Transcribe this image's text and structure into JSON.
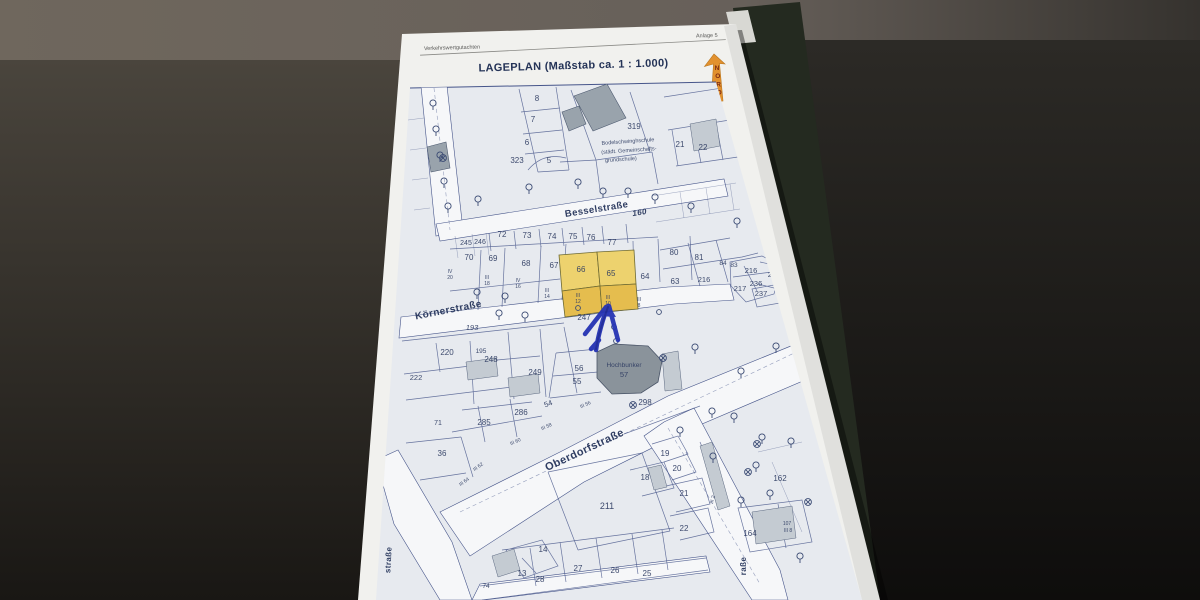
{
  "page": {
    "header_left": "Verkehrswertgutachten",
    "header_right": "Anlage 5",
    "title": "LAGEPLAN (Maßstab ca. 1 : 1.000)",
    "north_label": "NORD"
  },
  "colors": {
    "table-brown": "#6f675d",
    "bg-dark": "#171614",
    "paper": "#f1f1ee",
    "map-bg": "#e7eaef",
    "street": "#f6f7f9",
    "ink": "#46558a",
    "ink-text": "#2e3c62",
    "ink-street": "#26355b",
    "building": "#c4cbd2",
    "building-dark": "#99a3ac",
    "bunker": "#8a939b",
    "highlight-light": "#edd26e",
    "highlight-dark": "#e5bd4e",
    "arrow-blue": "#2533b4",
    "north-orange": "#e2912e",
    "north-text": "#7c2a12"
  },
  "map": {
    "bunker_name": "Hochbunker",
    "school_name": "Bodelschwinghschule (städt. Gemeinschafts- grundschule)",
    "highlighted_parcels": [
      "66",
      "65"
    ],
    "street_labels": [
      {
        "t": "Besselstraße",
        "x": 597,
        "y": 212,
        "r": -9,
        "fs": 9.5
      },
      {
        "t": "160",
        "x": 640,
        "y": 215,
        "r": -9,
        "fs": 8,
        "i": 1
      },
      {
        "t": "Körnerstraße",
        "x": 449,
        "y": 313,
        "r": -11,
        "fs": 10
      },
      {
        "t": "Oberdorfstraße",
        "x": 586,
        "y": 453,
        "r": -25,
        "fs": 11
      },
      {
        "t": "raße",
        "x": 746,
        "y": 566,
        "r": -90,
        "fs": 8
      },
      {
        "t": "straße",
        "x": 391,
        "y": 560,
        "r": -87,
        "fs": 8
      }
    ],
    "labels": [
      {
        "t": "8",
        "x": 537,
        "y": 101
      },
      {
        "t": "7",
        "x": 533,
        "y": 122
      },
      {
        "t": "6",
        "x": 527,
        "y": 145
      },
      {
        "t": "5",
        "x": 549,
        "y": 163
      },
      {
        "t": "323",
        "x": 517,
        "y": 163
      },
      {
        "t": "319",
        "x": 634,
        "y": 129
      },
      {
        "t": "21",
        "x": 680,
        "y": 147
      },
      {
        "t": "22",
        "x": 703,
        "y": 150
      },
      {
        "t": "Bodelschwinghschule",
        "x": 628,
        "y": 143,
        "fs": 5.5,
        "r": -4
      },
      {
        "t": "(städt. Gemeinschafts-",
        "x": 629,
        "y": 152,
        "fs": 5.5,
        "r": -4
      },
      {
        "t": "grundschule)",
        "x": 621,
        "y": 161,
        "fs": 5.5,
        "r": -4
      },
      {
        "t": "245",
        "x": 466,
        "y": 245,
        "fs": 7
      },
      {
        "t": "246",
        "x": 480,
        "y": 244,
        "fs": 7
      },
      {
        "t": "72",
        "x": 502,
        "y": 237
      },
      {
        "t": "73",
        "x": 527,
        "y": 238
      },
      {
        "t": "74",
        "x": 552,
        "y": 239
      },
      {
        "t": "75",
        "x": 573,
        "y": 239
      },
      {
        "t": "76",
        "x": 591,
        "y": 240
      },
      {
        "t": "77",
        "x": 612,
        "y": 245
      },
      {
        "t": "70",
        "x": 469,
        "y": 260
      },
      {
        "t": "69",
        "x": 493,
        "y": 261
      },
      {
        "t": "68",
        "x": 526,
        "y": 266
      },
      {
        "t": "67",
        "x": 554,
        "y": 268
      },
      {
        "t": "66",
        "x": 581,
        "y": 272
      },
      {
        "t": "65",
        "x": 611,
        "y": 276
      },
      {
        "t": "64",
        "x": 645,
        "y": 279
      },
      {
        "t": "63",
        "x": 675,
        "y": 284
      },
      {
        "t": "80",
        "x": 674,
        "y": 255
      },
      {
        "t": "81",
        "x": 699,
        "y": 260
      },
      {
        "t": "84",
        "x": 723,
        "y": 265,
        "fs": 6.5
      },
      {
        "t": "83",
        "x": 734,
        "y": 267,
        "fs": 6.5
      },
      {
        "t": "216",
        "x": 704,
        "y": 282,
        "fs": 7.5
      },
      {
        "t": "216",
        "x": 751,
        "y": 273,
        "fs": 7.5
      },
      {
        "t": "228",
        "x": 774,
        "y": 277,
        "fs": 7.5
      },
      {
        "t": "236",
        "x": 756,
        "y": 286,
        "fs": 7.5
      },
      {
        "t": "217",
        "x": 740,
        "y": 291,
        "fs": 7.5
      },
      {
        "t": "237",
        "x": 761,
        "y": 296,
        "fs": 7.5
      },
      {
        "t": "IV",
        "x": 450,
        "y": 273,
        "fs": 5
      },
      {
        "t": "20",
        "x": 450,
        "y": 279,
        "fs": 5
      },
      {
        "t": "III",
        "x": 487,
        "y": 279,
        "fs": 5
      },
      {
        "t": "18",
        "x": 487,
        "y": 285,
        "fs": 5
      },
      {
        "t": "IV",
        "x": 518,
        "y": 282,
        "fs": 5
      },
      {
        "t": "16",
        "x": 518,
        "y": 288,
        "fs": 5
      },
      {
        "t": "III",
        "x": 547,
        "y": 292,
        "fs": 5
      },
      {
        "t": "14",
        "x": 547,
        "y": 298,
        "fs": 5
      },
      {
        "t": "III",
        "x": 578,
        "y": 297,
        "fs": 5
      },
      {
        "t": "12",
        "x": 578,
        "y": 303,
        "fs": 5
      },
      {
        "t": "III",
        "x": 608,
        "y": 299,
        "fs": 5
      },
      {
        "t": "10",
        "x": 608,
        "y": 305,
        "fs": 5
      },
      {
        "t": "III",
        "x": 639,
        "y": 301,
        "fs": 5
      },
      {
        "t": "8",
        "x": 639,
        "y": 307,
        "fs": 5
      },
      {
        "t": "193",
        "x": 472,
        "y": 330,
        "i": 1,
        "fs": 7.5
      },
      {
        "t": "247",
        "x": 584,
        "y": 320
      },
      {
        "t": "220",
        "x": 447,
        "y": 355
      },
      {
        "t": "195",
        "x": 481,
        "y": 353,
        "fs": 6.5
      },
      {
        "t": "248",
        "x": 491,
        "y": 362
      },
      {
        "t": "249",
        "x": 535,
        "y": 375
      },
      {
        "t": "222",
        "x": 416,
        "y": 380,
        "fs": 7.5
      },
      {
        "t": "56",
        "x": 579,
        "y": 371
      },
      {
        "t": "55",
        "x": 577,
        "y": 384
      },
      {
        "t": "Hochbunker",
        "x": 624,
        "y": 367,
        "fs": 6.5
      },
      {
        "t": "57",
        "x": 624,
        "y": 377,
        "fs": 7.5
      },
      {
        "t": "298",
        "x": 645,
        "y": 405
      },
      {
        "t": "286",
        "x": 521,
        "y": 415
      },
      {
        "t": "285",
        "x": 484,
        "y": 425
      },
      {
        "t": "54",
        "x": 549,
        "y": 406,
        "r": -20,
        "fs": 7.5
      },
      {
        "t": "36",
        "x": 442,
        "y": 456
      },
      {
        "t": "71",
        "x": 438,
        "y": 425,
        "fs": 7
      },
      {
        "t": "III 56",
        "x": 586,
        "y": 406,
        "r": -24,
        "fs": 5
      },
      {
        "t": "III 58",
        "x": 547,
        "y": 428,
        "r": -24,
        "fs": 5
      },
      {
        "t": "III 60",
        "x": 516,
        "y": 443,
        "r": -24,
        "fs": 5
      },
      {
        "t": "III 62",
        "x": 479,
        "y": 468,
        "r": -35,
        "fs": 5
      },
      {
        "t": "III 64",
        "x": 465,
        "y": 483,
        "r": -35,
        "fs": 5
      },
      {
        "t": "19",
        "x": 665,
        "y": 456
      },
      {
        "t": "20",
        "x": 677,
        "y": 471
      },
      {
        "t": "18",
        "x": 645,
        "y": 480
      },
      {
        "t": "21",
        "x": 684,
        "y": 496
      },
      {
        "t": "22",
        "x": 684,
        "y": 531
      },
      {
        "t": "211",
        "x": 607,
        "y": 509,
        "fs": 9
      },
      {
        "t": "162",
        "x": 780,
        "y": 481
      },
      {
        "t": "164",
        "x": 750,
        "y": 536
      },
      {
        "t": "107",
        "x": 787,
        "y": 525,
        "fs": 5
      },
      {
        "t": "III 8",
        "x": 788,
        "y": 532,
        "fs": 5
      },
      {
        "t": "III 2",
        "x": 714,
        "y": 500,
        "r": -75,
        "fs": 5
      },
      {
        "t": "14",
        "x": 543,
        "y": 552
      },
      {
        "t": "13",
        "x": 522,
        "y": 576
      },
      {
        "t": "28",
        "x": 540,
        "y": 582
      },
      {
        "t": "27",
        "x": 578,
        "y": 571
      },
      {
        "t": "26",
        "x": 615,
        "y": 573
      },
      {
        "t": "25",
        "x": 647,
        "y": 576
      },
      {
        "t": "74",
        "x": 486,
        "y": 588,
        "fs": 6.5
      }
    ],
    "symbols": {
      "trees": [
        [
          433,
          103
        ],
        [
          436,
          129
        ],
        [
          440,
          155
        ],
        [
          444,
          181
        ],
        [
          448,
          206
        ],
        [
          478,
          199
        ],
        [
          529,
          187
        ],
        [
          578,
          182
        ],
        [
          603,
          191
        ],
        [
          628,
          191
        ],
        [
          655,
          197
        ],
        [
          691,
          206
        ],
        [
          737,
          221
        ],
        [
          477,
          292
        ],
        [
          505,
          296
        ],
        [
          499,
          313
        ],
        [
          525,
          315
        ],
        [
          695,
          347
        ],
        [
          741,
          371
        ],
        [
          776,
          346
        ],
        [
          712,
          411
        ],
        [
          734,
          416
        ],
        [
          762,
          437
        ],
        [
          791,
          441
        ],
        [
          713,
          456
        ],
        [
          756,
          465
        ],
        [
          770,
          493
        ],
        [
          741,
          500
        ],
        [
          800,
          556
        ],
        [
          680,
          430
        ]
      ],
      "lamps": [
        [
          633,
          405
        ],
        [
          663,
          358
        ],
        [
          748,
          472
        ],
        [
          808,
          502
        ],
        [
          443,
          158
        ],
        [
          757,
          444
        ]
      ],
      "points": [
        [
          578,
          308
        ],
        [
          614,
          327
        ],
        [
          616,
          341
        ],
        [
          659,
          312
        ]
      ]
    }
  }
}
